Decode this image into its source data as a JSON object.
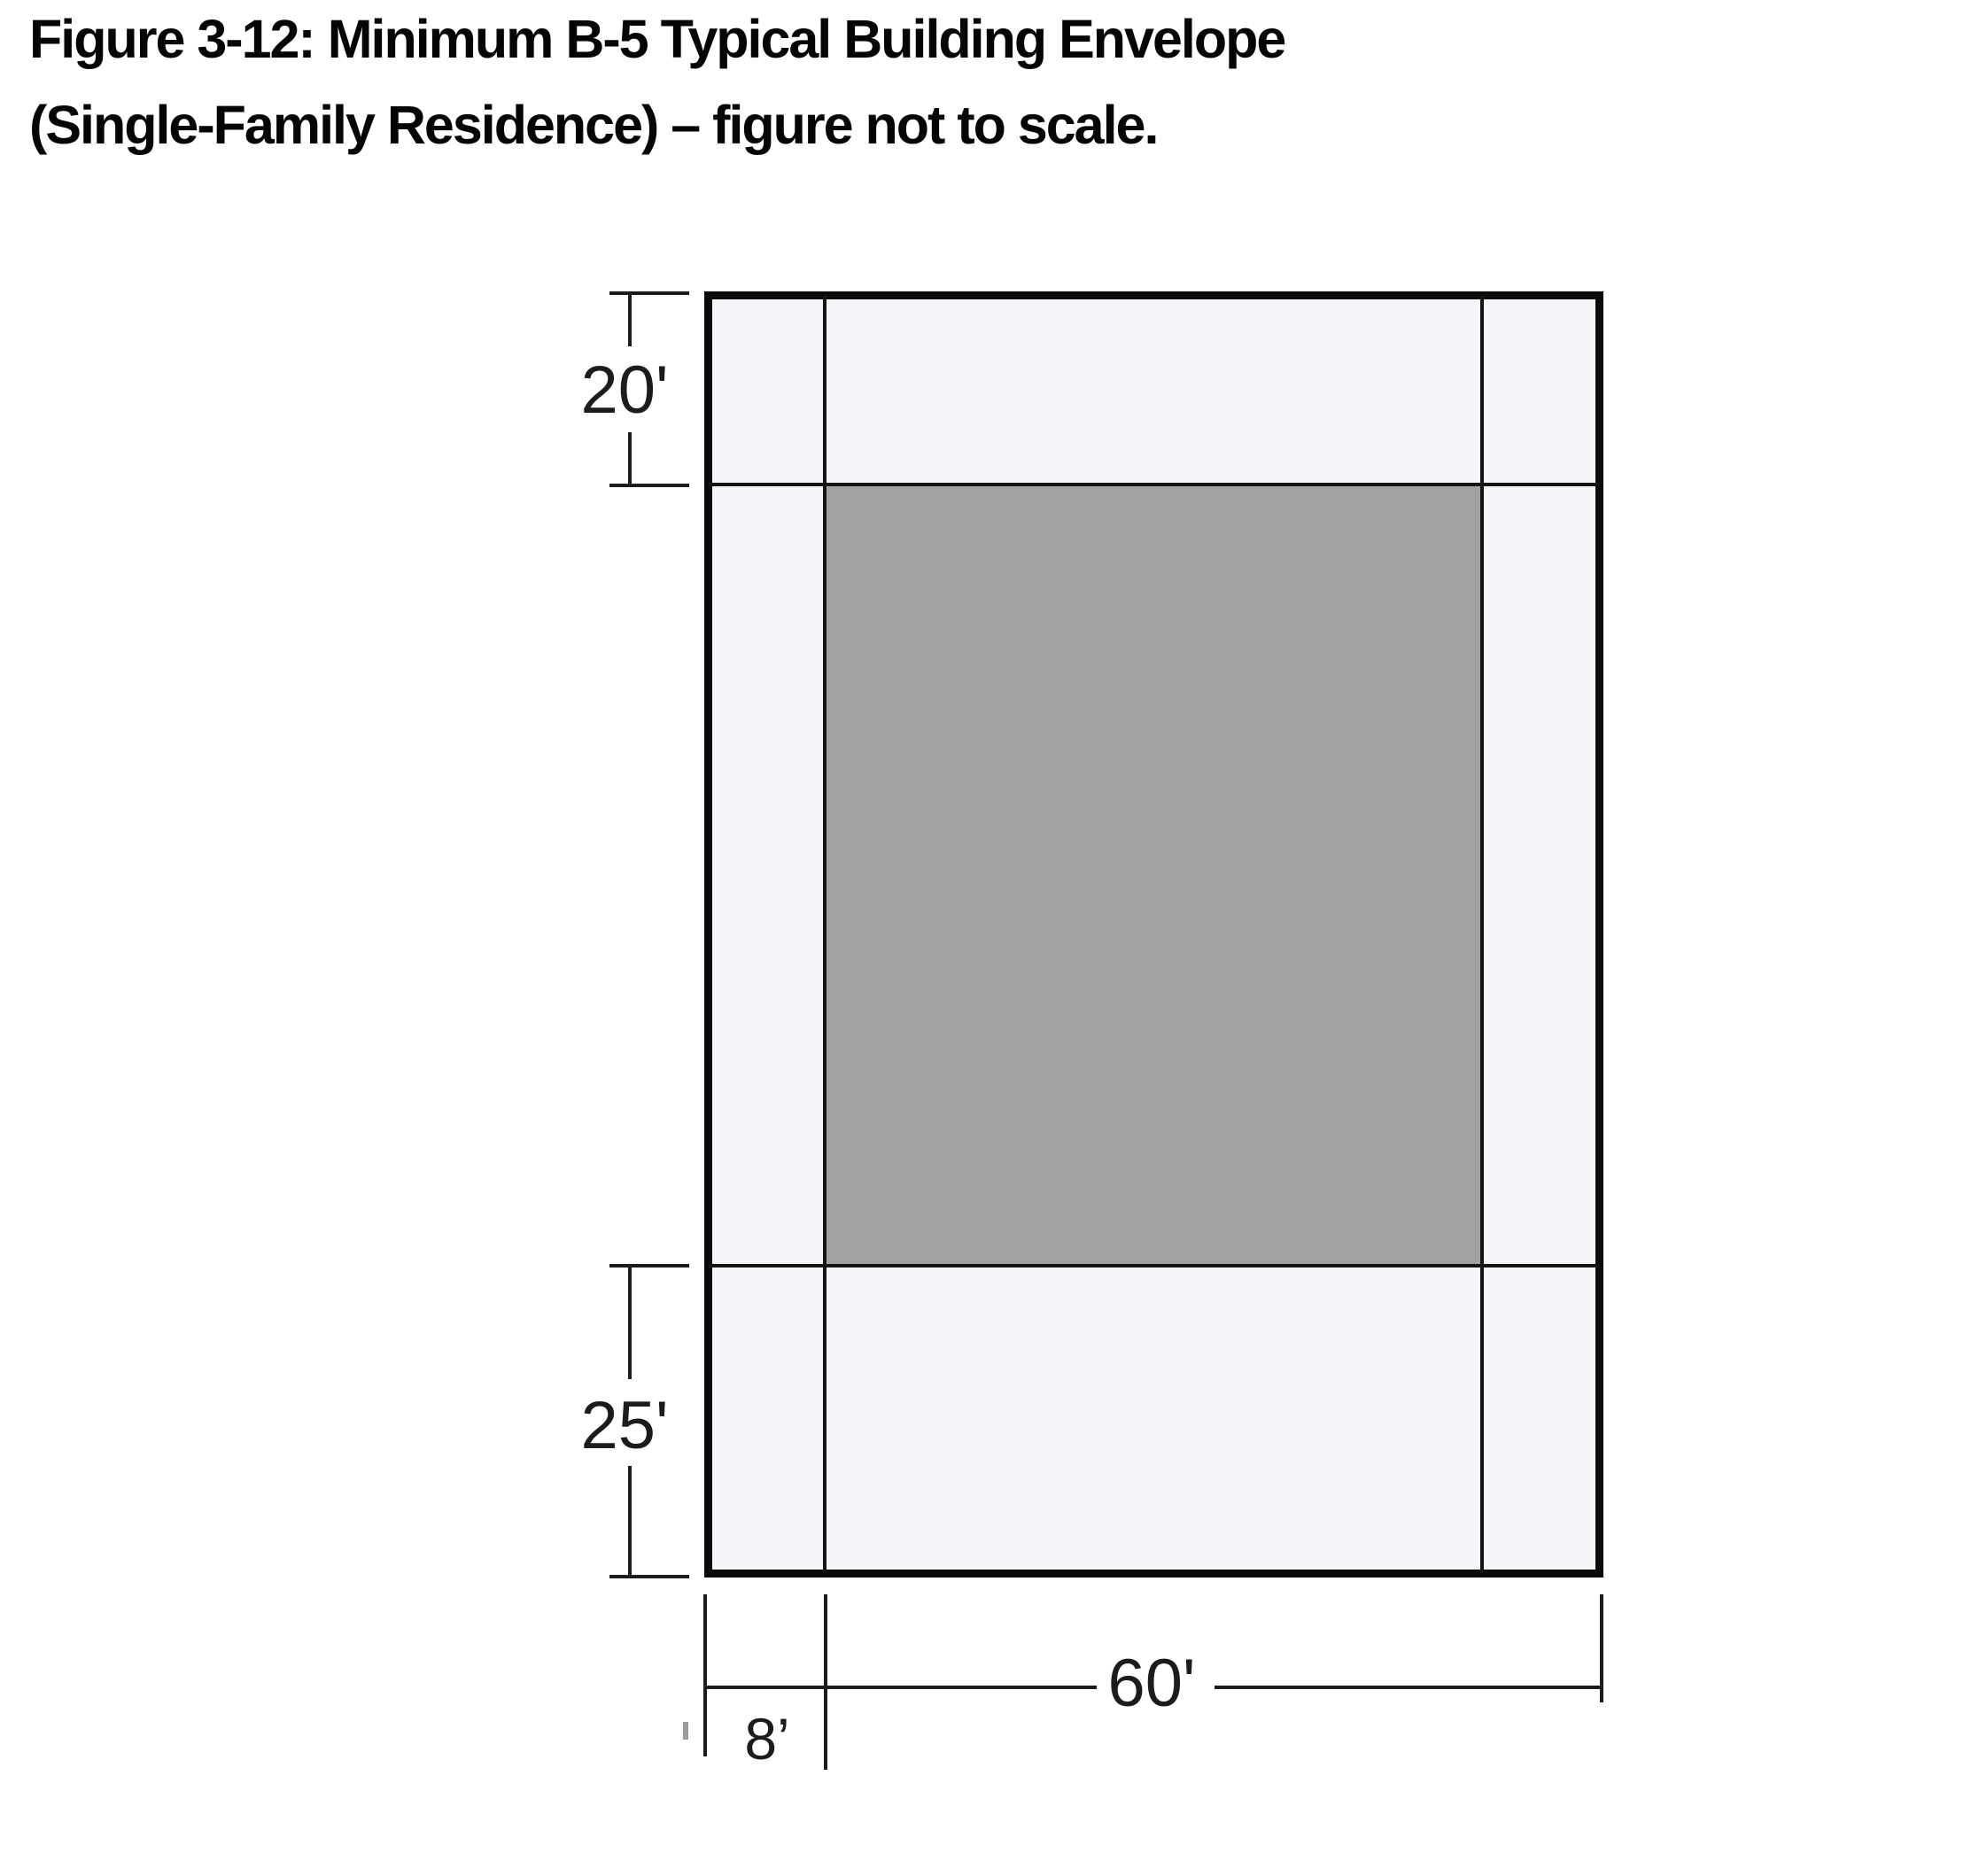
{
  "figure": {
    "title_line1": "Figure 3-12: Minimum B-5 Typical Building Envelope",
    "title_line2": "(Single-Family Residence) – figure not to scale."
  },
  "diagram": {
    "colors": {
      "lot-fill": "#f5f5f9",
      "envelope-fill": "#a1a1a2",
      "line-color": "#141414",
      "dim-color": "#1c1c1c",
      "title-color": "#050505"
    },
    "dimensions": {
      "front_setback_label": "20'",
      "rear_setback_label": "25'",
      "side_setback_label": "8’",
      "width_label": "60'"
    }
  }
}
